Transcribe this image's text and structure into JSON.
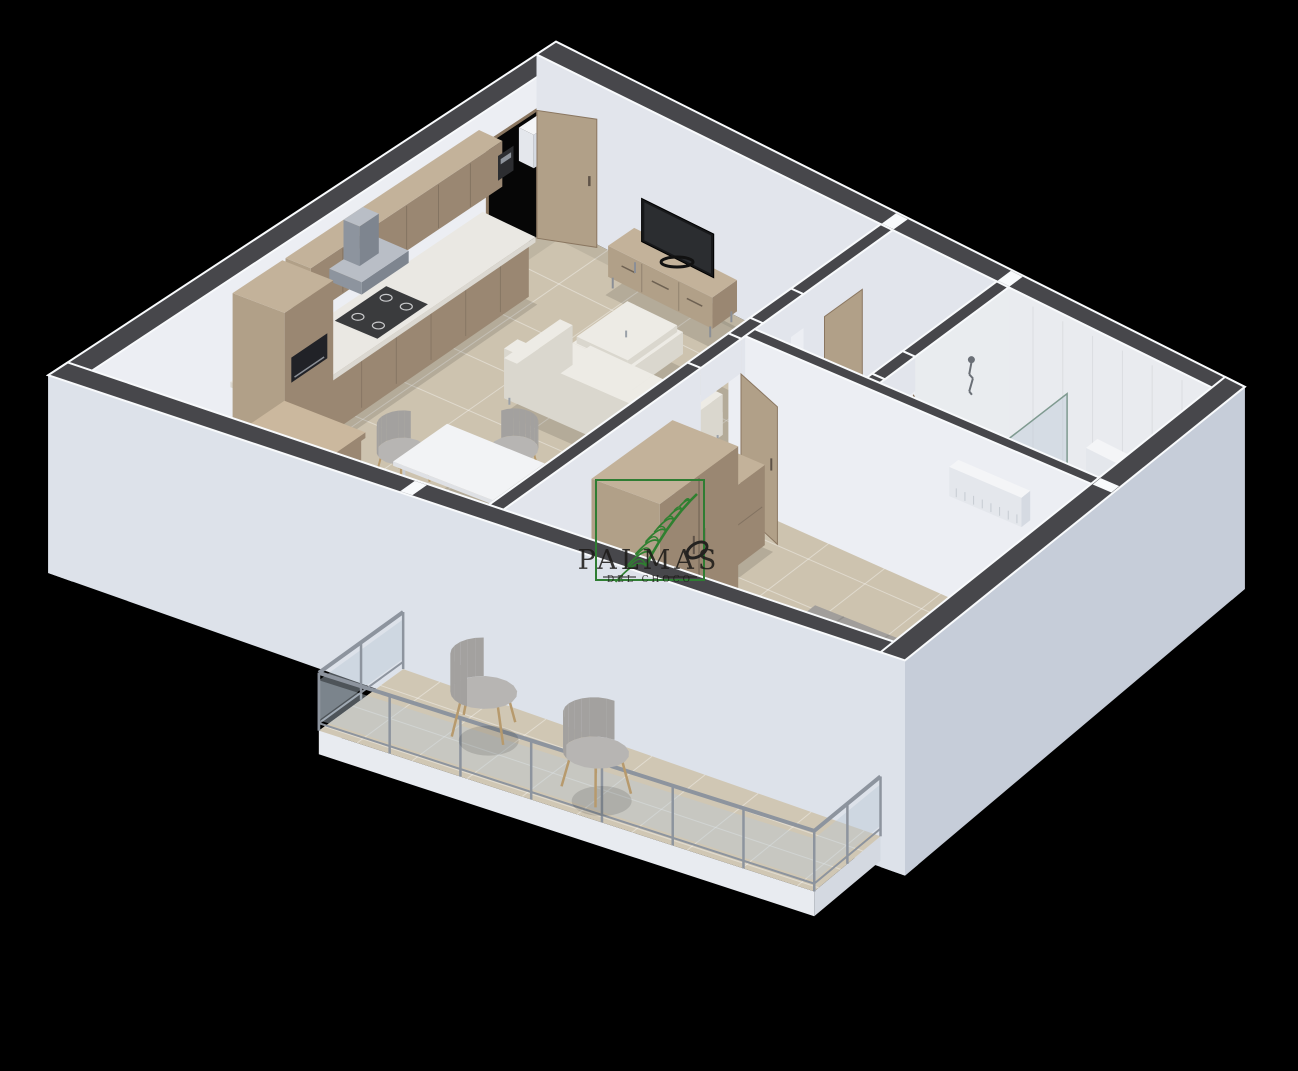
{
  "watermark": {
    "title": "PALMAS",
    "subtitle": "DEL CHOCO",
    "frame_color": "#2f7d33",
    "leaf_color": "#2f8030",
    "text_color": "#1d1b19"
  },
  "scene": {
    "background": "#000000",
    "view": "isometric-3d-floor-plan",
    "colors": {
      "wallTop": "#47474b",
      "wallTrim": "#f8fafc",
      "wallInnerNW": "#eceef3",
      "wallInnerNE": "#e2e5ec",
      "wallOuterSW": "#dde2ea",
      "wallOuterSE": "#c6cdd9",
      "wallEnd": "#d2d7e0",
      "floor": "#cdc3af",
      "floorGrout": "rgba(255,255,255,0.38)",
      "bathFloor": "#d9d3c6",
      "showerFloor": "#e2ddd2",
      "balconyFloor": "#d0c7b4",
      "tileWall": "#e9ecef",
      "woodTop": "#c3b29a",
      "woodFront": "#b1a088",
      "woodSide": "#9a8772",
      "woodDark": "#8a7660",
      "counterTop": "#eae8e3",
      "counterSide": "#dbd8d1",
      "fabric": "#edebe5",
      "fabricShade": "#dad7ce",
      "grayChair": "#b7b5b3",
      "grayChairShade": "#a3a19f",
      "duvet": "#a19e9b",
      "duvetShade": "#8f8c89",
      "pillow": "#f1f0ee",
      "dark": "#212227",
      "tvScreen": "#17181a",
      "glass": "rgba(186,200,212,0.42)",
      "winGlass": "rgba(120,136,152,0.6)",
      "frame": "#9aa3ae",
      "white": "#f4f5f7",
      "whiteS": "#e4e7ec",
      "whiteE": "#d5dae2",
      "metal": "#8d949e",
      "curtain": "#cdbfa7",
      "curtainShade": "#b4a68e",
      "blindA": "#cfc4ad",
      "blindB": "#b9ae97",
      "black": "#060606",
      "shadow": "rgba(0,0,0,0.12)",
      "legWood": "#b79a6d"
    },
    "rooms": [
      {
        "name": "living-dining-room",
        "furniture": [
          "tv-stand",
          "television",
          "sectional-sofa",
          "dining-table",
          "dining-chair",
          "dining-chair",
          "dining-chair",
          "dining-chair"
        ]
      },
      {
        "name": "kitchen",
        "furniture": [
          "base-cabinets",
          "upper-cabinets",
          "countertop",
          "cooktop",
          "range-hood",
          "microwave",
          "tall-cabinet",
          "peninsula-cabinet",
          "water-heater",
          "electrical-panel"
        ]
      },
      {
        "name": "hallway",
        "furniture": [
          "closet-door"
        ]
      },
      {
        "name": "bathroom",
        "furniture": [
          "shower",
          "glass-partition",
          "hand-shower",
          "toilet",
          "vanity"
        ]
      },
      {
        "name": "bedroom",
        "furniture": [
          "double-bed",
          "wardrobe",
          "dresser",
          "air-conditioner",
          "bedroom-door",
          "vertical-blinds"
        ]
      },
      {
        "name": "balcony",
        "furniture": [
          "glass-railing",
          "lounge-chair",
          "lounge-chair",
          "sliding-door",
          "curtain"
        ]
      }
    ]
  }
}
